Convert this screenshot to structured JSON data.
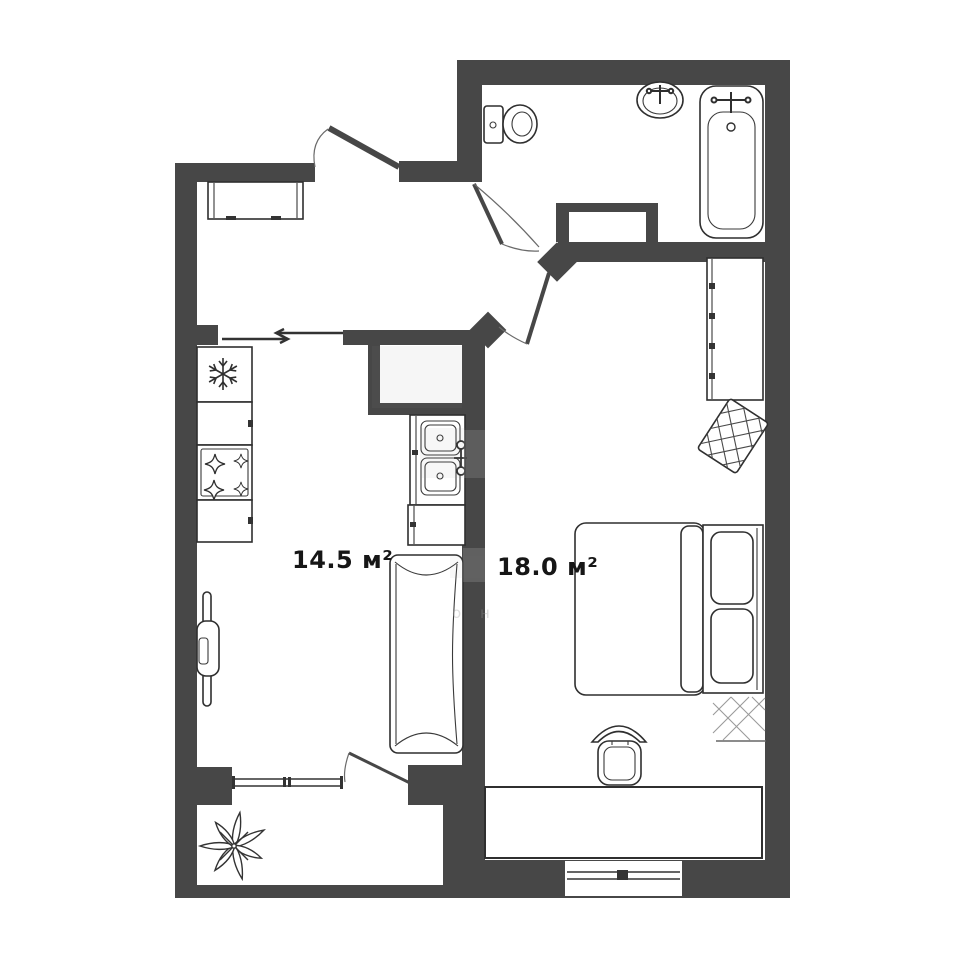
{
  "plan": {
    "title": "apartment floor plan",
    "colors": {
      "wall": "#474747",
      "outline": "#2f2f2f",
      "label": "#161616",
      "background": "#ffffff",
      "watermark": "#9a9a9a"
    },
    "rooms": {
      "kitchen": {
        "area_label": "14.5 м²"
      },
      "bedroom": {
        "area_label": "18.0 м²"
      }
    },
    "watermark": {
      "letters": "о н"
    },
    "fixtures": {
      "bathroom": [
        "toilet",
        "washbasin",
        "bathtub",
        "vent-shaft"
      ],
      "hallway": [
        "entrance-door",
        "cabinet"
      ],
      "kitchen": [
        "fridge",
        "counter",
        "stove",
        "counter",
        "double-sink",
        "base-cabinet",
        "folding-table",
        "sofa",
        "sliding-door"
      ],
      "bedroom": [
        "wardrobe",
        "rug",
        "double-bed",
        "desk",
        "chair",
        "window"
      ],
      "balcony": [
        "window",
        "balcony-door",
        "plant"
      ]
    }
  }
}
